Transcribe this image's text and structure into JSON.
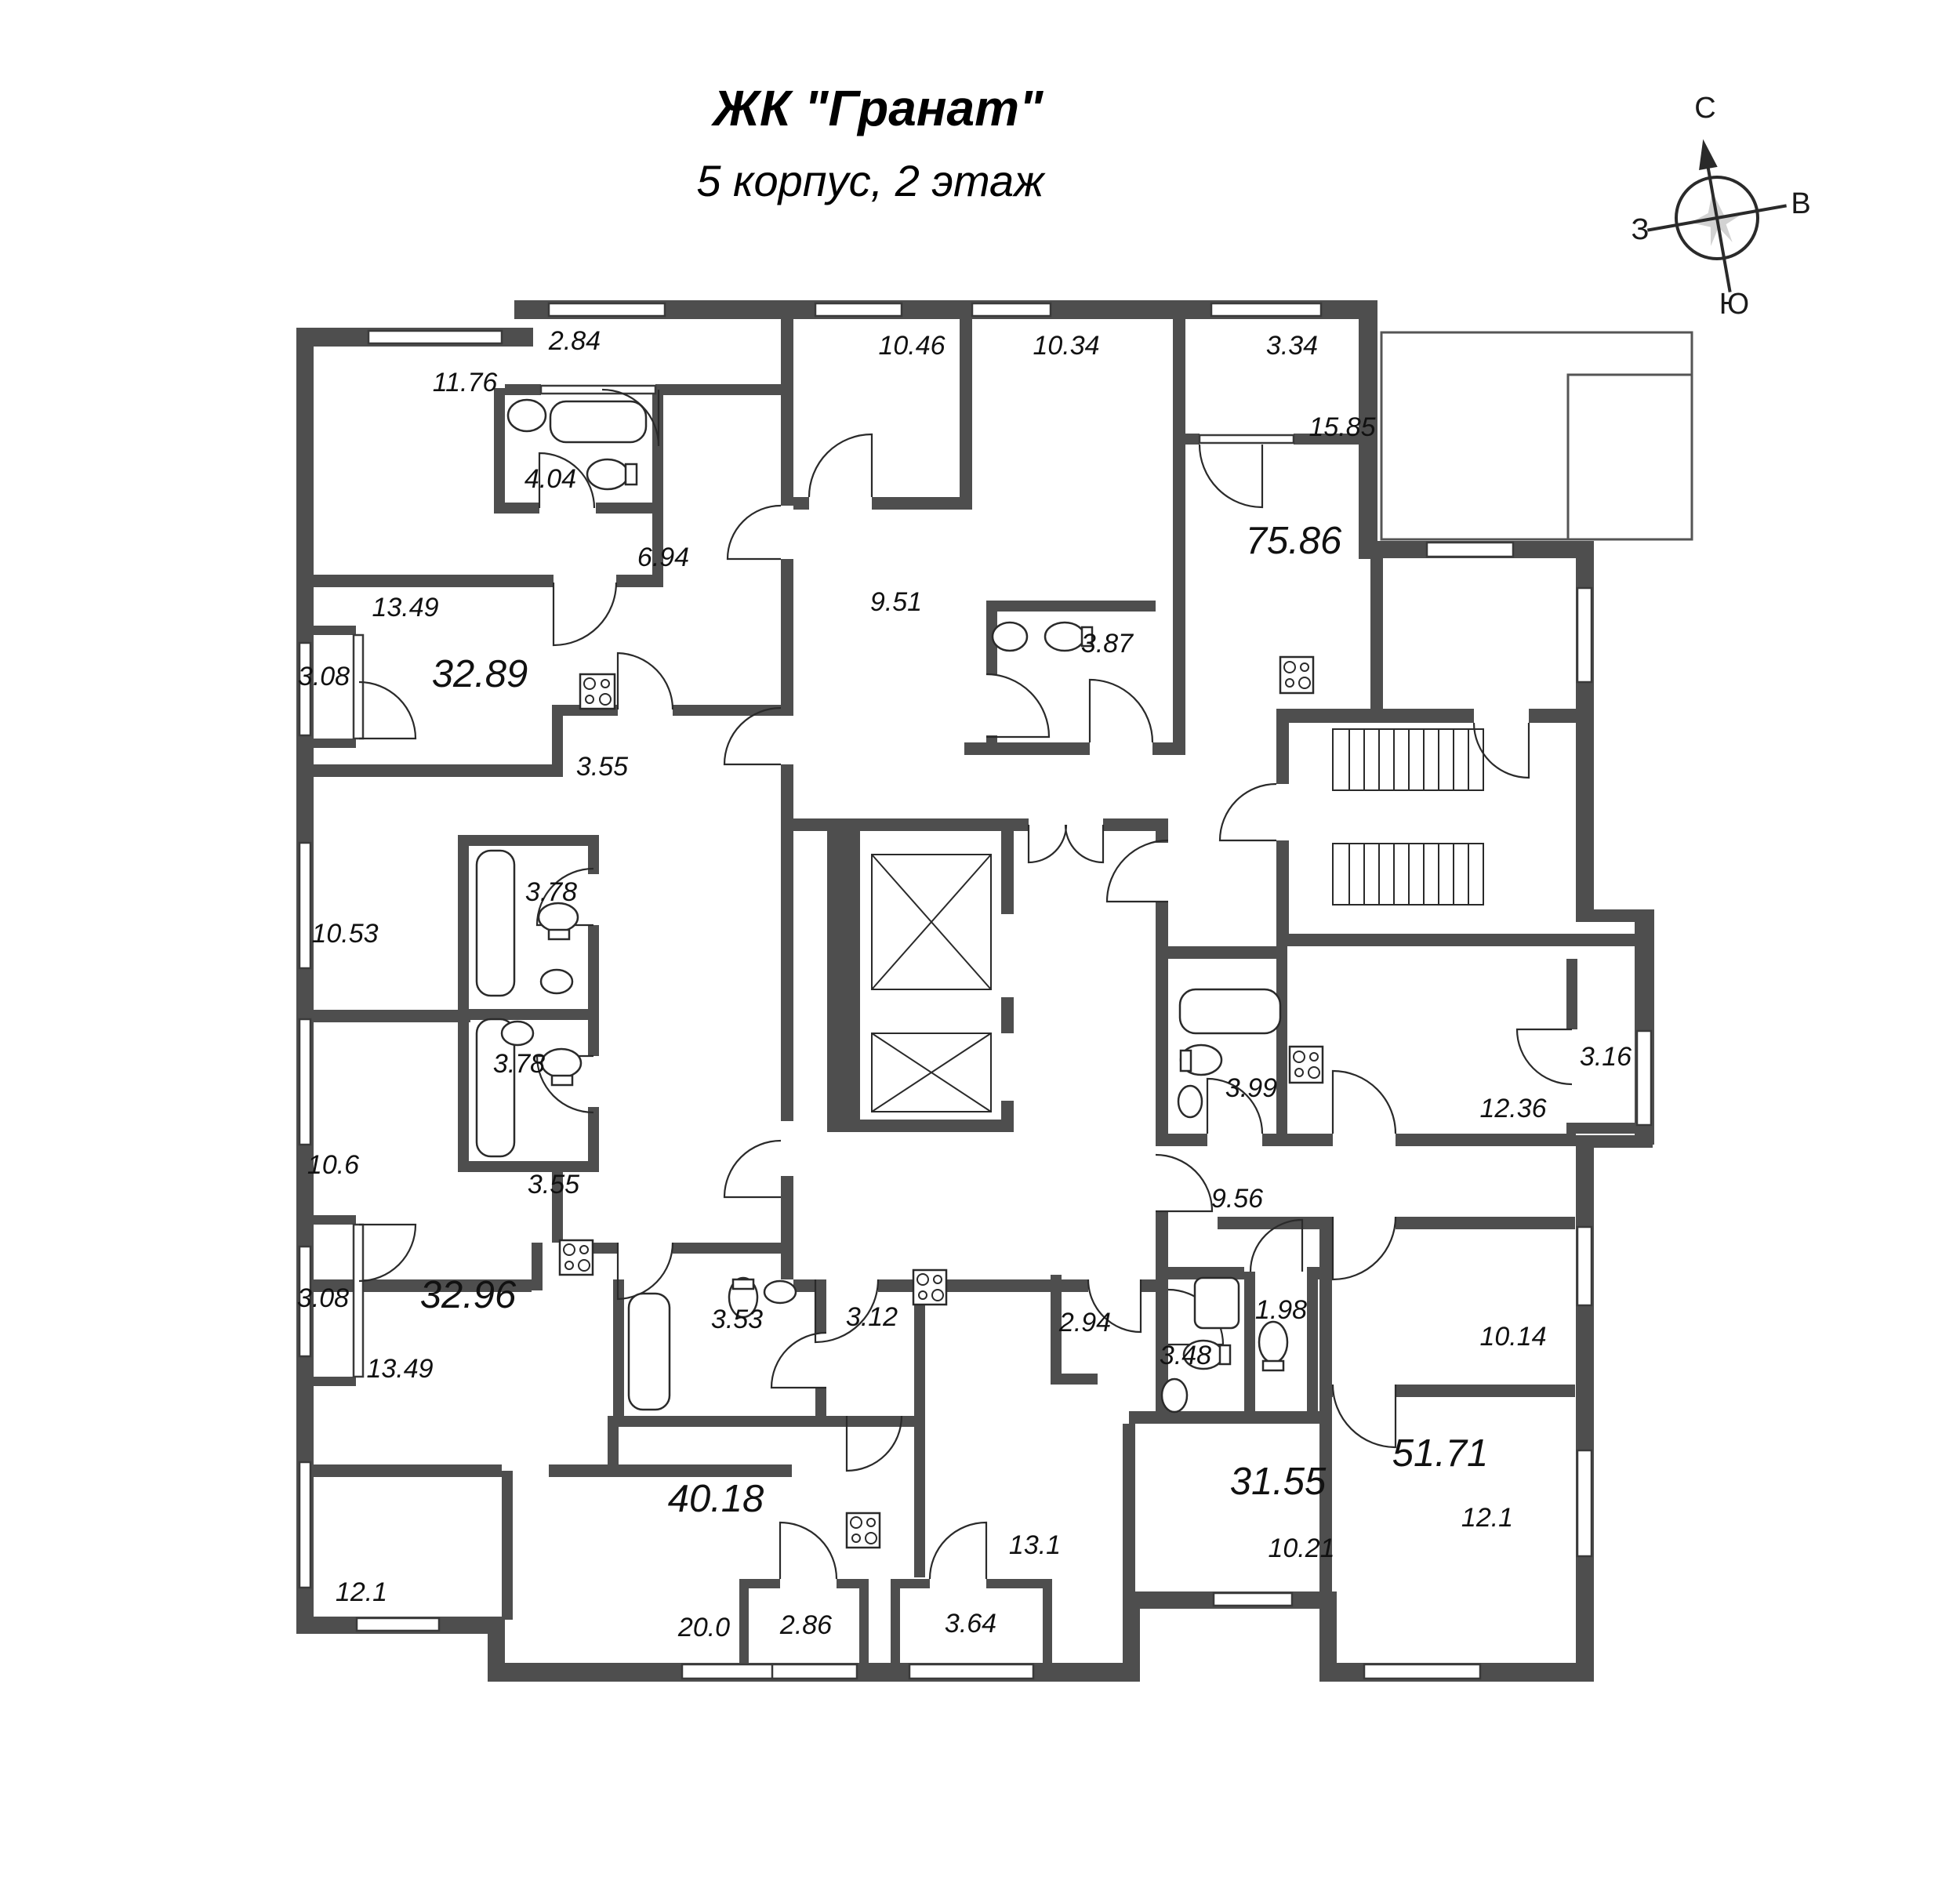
{
  "title": {
    "line1": "ЖК \"Гранат\"",
    "line2": "5 корпус, 2 этаж"
  },
  "compass": {
    "north": "С",
    "east": "В",
    "south": "Ю",
    "west": "З"
  },
  "colors": {
    "wall": "#4e4e4e",
    "line": "#2a2a2a",
    "text": "#111111",
    "background": "#ffffff"
  },
  "apartments": [
    {
      "name": "apartment-75-86",
      "total": "75.86",
      "rooms": [
        {
          "area": "2.84"
        },
        {
          "area": "11.76"
        },
        {
          "area": "10.46"
        },
        {
          "area": "10.34"
        },
        {
          "area": "3.34"
        },
        {
          "area": "15.85"
        },
        {
          "area": "4.04"
        },
        {
          "area": "6.94"
        },
        {
          "area": "9.51"
        },
        {
          "area": "3.87"
        }
      ]
    },
    {
      "name": "apartment-32-89",
      "total": "32.89",
      "rooms": [
        {
          "area": "13.49"
        },
        {
          "area": "3.08"
        },
        {
          "area": "3.55"
        },
        {
          "area": "3.78"
        },
        {
          "area": "10.53"
        }
      ]
    },
    {
      "name": "apartment-32-96",
      "total": "32.96",
      "rooms": [
        {
          "area": "3.78"
        },
        {
          "area": "10.6"
        },
        {
          "area": "3.55"
        },
        {
          "area": "3.08"
        },
        {
          "area": "13.49"
        }
      ]
    },
    {
      "name": "apartment-40-18",
      "total": "40.18",
      "rooms": [
        {
          "area": "3.53"
        },
        {
          "area": "3.12"
        },
        {
          "area": "12.1"
        },
        {
          "area": "20.0"
        },
        {
          "area": "2.86"
        }
      ]
    },
    {
      "name": "apartment-31-55",
      "total": "31.55",
      "rooms": [
        {
          "area": "2.94"
        },
        {
          "area": "3.48"
        },
        {
          "area": "13.1"
        },
        {
          "area": "10.21"
        },
        {
          "area": "3.64"
        }
      ]
    },
    {
      "name": "apartment-51-71",
      "total": "51.71",
      "rooms": [
        {
          "area": "3.99"
        },
        {
          "area": "12.36"
        },
        {
          "area": "3.16"
        },
        {
          "area": "9.56"
        },
        {
          "area": "1.98"
        },
        {
          "area": "10.14"
        },
        {
          "area": "12.1"
        }
      ]
    }
  ]
}
